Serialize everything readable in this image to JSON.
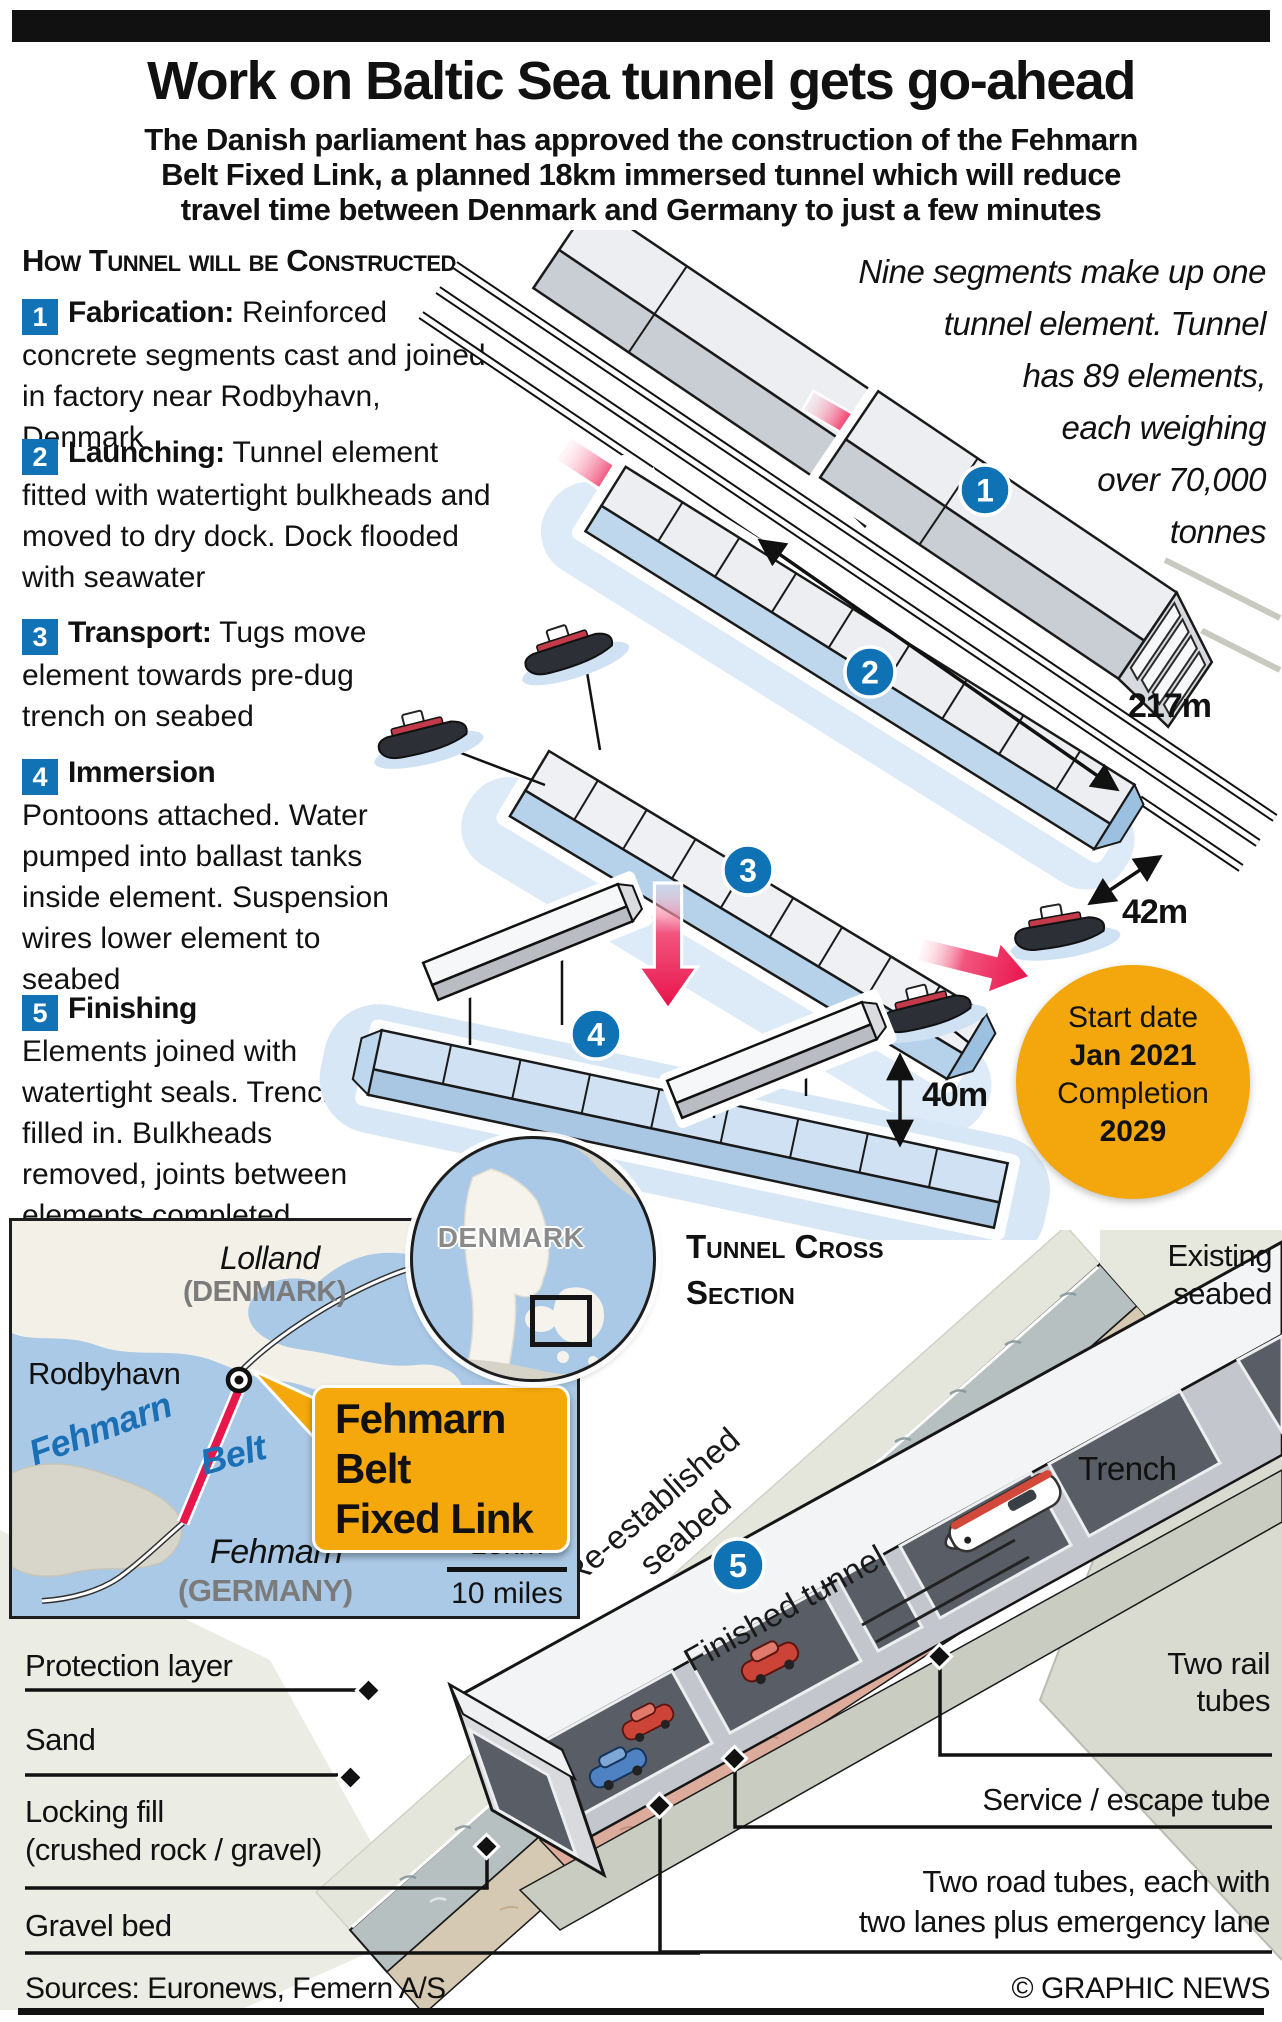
{
  "header": {
    "title": "Work on Baltic Sea tunnel gets go-ahead",
    "subtitle_lines": [
      "The Danish parliament has approved the construction of the Fehmarn",
      "Belt Fixed Link, a planned 18km immersed tunnel which will reduce",
      "travel time between Denmark and Germany to just a few minutes"
    ]
  },
  "construction": {
    "section_title": "How Tunnel will be Constructed",
    "steps": [
      {
        "num": "1",
        "title": "Fabrication:",
        "text": "Reinforced concrete segments cast and joined in factory near Rodbyhavn, Denmark"
      },
      {
        "num": "2",
        "title": "Launching:",
        "text": "Tunnel element fitted with watertight bulkheads and moved to dry dock. Dock flooded with seawater"
      },
      {
        "num": "3",
        "title": "Transport:",
        "text": "Tugs move element towards pre-dug trench on seabed"
      },
      {
        "num": "4",
        "title": "Immersion",
        "text": "Pontoons attached. Water pumped into ballast tanks inside element. Suspension wires lower element to seabed"
      },
      {
        "num": "5",
        "title": "Finishing",
        "text": "Elements joined with watertight seals. Trench filled in. Bulkheads removed, joints between elements completed"
      }
    ],
    "note_lines": [
      "Nine segments make up one",
      "tunnel element. Tunnel",
      "has 89 elements,",
      "each weighing",
      "over 70,000",
      "tonnes"
    ],
    "measurements": {
      "length": "217m",
      "width": "42m",
      "depth": "40m"
    },
    "schedule": {
      "start_label": "Start date",
      "start_value": "Jan 2021",
      "completion_label": "Completion",
      "completion_value": "2029"
    }
  },
  "map": {
    "region_label": "Lolland",
    "region_country": "(DENMARK)",
    "port": "Rodbyhavn",
    "strait_word1": "Fehmarn",
    "strait_word2": "Belt",
    "island_label": "Fehmarn",
    "island_country": "(GERMANY)",
    "callout_line1": "Fehmarn Belt",
    "callout_line2": "Fixed Link",
    "scale_km": "15km",
    "scale_miles": "10 miles",
    "inset_label": "DENMARK"
  },
  "cross_section": {
    "title_line1": "Tunnel Cross",
    "title_line2": "Section",
    "step_num": "5",
    "labels": {
      "existing_line1": "Existing",
      "existing_line2": "seabed",
      "reestablished_line1": "Re-established",
      "reestablished_line2": "seabed",
      "trench": "Trench",
      "finished_tunnel": "Finished tunnel",
      "protection": "Protection layer",
      "sand": "Sand",
      "locking_line1": "Locking fill",
      "locking_line2": "(crushed rock / gravel)",
      "gravel": "Gravel bed",
      "rail_line1": "Two rail",
      "rail_line2": "tubes",
      "service": "Service / escape tube",
      "road_line1": "Two road tubes, each with",
      "road_line2": "two lanes plus emergency lane"
    }
  },
  "footer": {
    "sources": "Sources: Euronews, Femern A/S",
    "credit": "© GRAPHIC NEWS"
  },
  "colors": {
    "step_blue": "#1173b6",
    "arrow_red": "#e8174b",
    "badge_yellow": "#f3a70c",
    "map_water": "#aac9e6",
    "element_blue": "#cfe1f3"
  }
}
